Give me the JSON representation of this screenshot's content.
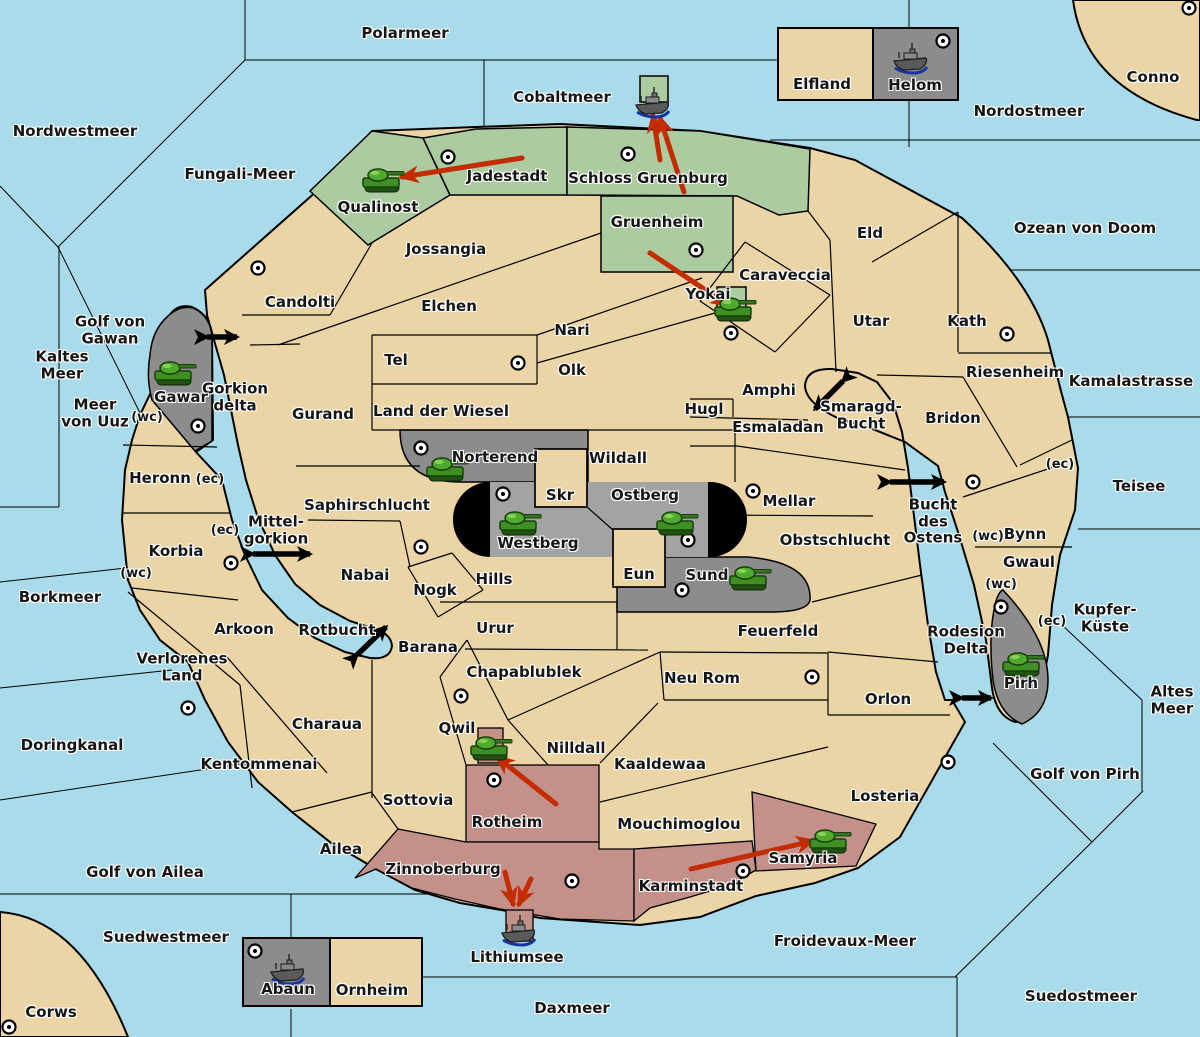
{
  "map": {
    "title": "Gorkion world game map",
    "colors": {
      "water": "#a9dbea",
      "land": "#ebd5a6",
      "green": "#adcba0",
      "gray": "#8c8c8c",
      "gray_light": "#a3a3a3",
      "pink": "#c4908a",
      "black": "#000000",
      "red_arrow": "#c32b00",
      "label": "#161616"
    },
    "sea_labels": [
      {
        "t": "Polarmeer",
        "x": 405,
        "y": 33
      },
      {
        "t": "Nordwestmeer",
        "x": 75,
        "y": 131
      },
      {
        "t": "Fungali-Meer",
        "x": 240,
        "y": 174
      },
      {
        "t": "Cobaltmeer",
        "x": 562,
        "y": 97
      },
      {
        "t": "Nordostmeer",
        "x": 1029,
        "y": 111
      },
      {
        "t": "Ozean von Doom",
        "x": 1085,
        "y": 228
      },
      {
        "t": "Kaltes\nMeer",
        "x": 62,
        "y": 365
      },
      {
        "t": "Golf von\nGawan",
        "x": 110,
        "y": 330
      },
      {
        "t": "Meer\nvon Uuz",
        "x": 95,
        "y": 413
      },
      {
        "t": "Gorkion\ndelta",
        "x": 235,
        "y": 397
      },
      {
        "t": "Kamalastrasse",
        "x": 1131,
        "y": 381
      },
      {
        "t": "Teisee",
        "x": 1139,
        "y": 486
      },
      {
        "t": "Borkmeer",
        "x": 60,
        "y": 597
      },
      {
        "t": "Mittel-\ngorkion",
        "x": 276,
        "y": 530
      },
      {
        "t": "Bucht\ndes\nOstens",
        "x": 933,
        "y": 521
      },
      {
        "t": "Smaragd-\nBucht",
        "x": 861,
        "y": 415
      },
      {
        "t": "Kupfer-\nKüste",
        "x": 1105,
        "y": 618
      },
      {
        "t": "Altes\nMeer",
        "x": 1172,
        "y": 700
      },
      {
        "t": "Rotbucht",
        "x": 337,
        "y": 630
      },
      {
        "t": "Rodesion\nDelta",
        "x": 966,
        "y": 640
      },
      {
        "t": "Doringkanal",
        "x": 72,
        "y": 745
      },
      {
        "t": "Golf von Ailea",
        "x": 145,
        "y": 872
      },
      {
        "t": "Suedwestmeer",
        "x": 166,
        "y": 937
      },
      {
        "t": "Daxmeer",
        "x": 572,
        "y": 1008
      },
      {
        "t": "Froidevaux-Meer",
        "x": 845,
        "y": 941
      },
      {
        "t": "Suedostmeer",
        "x": 1081,
        "y": 996
      },
      {
        "t": "Golf von Pirh",
        "x": 1085,
        "y": 774
      },
      {
        "t": "Lithiumsee",
        "x": 517,
        "y": 957
      }
    ],
    "land_labels": [
      {
        "t": "Elfland",
        "x": 822,
        "y": 84
      },
      {
        "t": "Helom",
        "x": 915,
        "y": 85
      },
      {
        "t": "Conno",
        "x": 1153,
        "y": 77
      },
      {
        "t": "Corws",
        "x": 51,
        "y": 1012
      },
      {
        "t": "Jadestadt",
        "x": 507,
        "y": 176
      },
      {
        "t": "Schloss Gruenburg",
        "x": 648,
        "y": 178
      },
      {
        "t": "Qualinost",
        "x": 378,
        "y": 207
      },
      {
        "t": "Gruenheim",
        "x": 657,
        "y": 222
      },
      {
        "t": "Jossangia",
        "x": 446,
        "y": 249
      },
      {
        "t": "Candolti",
        "x": 300,
        "y": 302
      },
      {
        "t": "Elchen",
        "x": 449,
        "y": 306
      },
      {
        "t": "Yokai",
        "x": 708,
        "y": 294
      },
      {
        "t": "Nari",
        "x": 572,
        "y": 330
      },
      {
        "t": "Eld",
        "x": 870,
        "y": 233
      },
      {
        "t": "Caraveccia",
        "x": 785,
        "y": 275
      },
      {
        "t": "Utar",
        "x": 871,
        "y": 321
      },
      {
        "t": "Kath",
        "x": 967,
        "y": 321
      },
      {
        "t": "Tel",
        "x": 396,
        "y": 360
      },
      {
        "t": "Olk",
        "x": 572,
        "y": 370
      },
      {
        "t": "Riesenheim",
        "x": 1015,
        "y": 372
      },
      {
        "t": "Gawar",
        "x": 181,
        "y": 397
      },
      {
        "t": "Amphi",
        "x": 769,
        "y": 390
      },
      {
        "t": "Hugl",
        "x": 704,
        "y": 409
      },
      {
        "t": "Esmaladan",
        "x": 778,
        "y": 427
      },
      {
        "t": "Bridon",
        "x": 953,
        "y": 418
      },
      {
        "t": "Gurand",
        "x": 323,
        "y": 414
      },
      {
        "t": "Land der Wiesel",
        "x": 441,
        "y": 411
      },
      {
        "t": "Norterend",
        "x": 495,
        "y": 457
      },
      {
        "t": "Wildall",
        "x": 618,
        "y": 458
      },
      {
        "t": "Skr",
        "x": 560,
        "y": 495
      },
      {
        "t": "Ostberg",
        "x": 645,
        "y": 495
      },
      {
        "t": "Westberg",
        "x": 538,
        "y": 543
      },
      {
        "t": "Mellar",
        "x": 789,
        "y": 501
      },
      {
        "t": "Heronn",
        "x": 160,
        "y": 478
      },
      {
        "t": "Saphirschlucht",
        "x": 367,
        "y": 505
      },
      {
        "t": "Korbia",
        "x": 176,
        "y": 551
      },
      {
        "t": "Obstschlucht",
        "x": 835,
        "y": 540
      },
      {
        "t": "Bynn",
        "x": 1025,
        "y": 534
      },
      {
        "t": "Gwaul",
        "x": 1029,
        "y": 562
      },
      {
        "t": "Nabai",
        "x": 365,
        "y": 575
      },
      {
        "t": "Nogk",
        "x": 435,
        "y": 590
      },
      {
        "t": "Hills",
        "x": 494,
        "y": 579
      },
      {
        "t": "Eun",
        "x": 639,
        "y": 574
      },
      {
        "t": "Sund",
        "x": 707,
        "y": 575
      },
      {
        "t": "Urur",
        "x": 495,
        "y": 628
      },
      {
        "t": "Barana",
        "x": 428,
        "y": 647
      },
      {
        "t": "Arkoon",
        "x": 244,
        "y": 629
      },
      {
        "t": "Verlorenes\nLand",
        "x": 182,
        "y": 667
      },
      {
        "t": "Charaua",
        "x": 327,
        "y": 724
      },
      {
        "t": "Kentommenai",
        "x": 259,
        "y": 764
      },
      {
        "t": "Sottovia",
        "x": 418,
        "y": 800
      },
      {
        "t": "Ailea",
        "x": 341,
        "y": 849
      },
      {
        "t": "Chapablublek",
        "x": 524,
        "y": 672
      },
      {
        "t": "Qwil",
        "x": 457,
        "y": 728
      },
      {
        "t": "Nilldall",
        "x": 576,
        "y": 748
      },
      {
        "t": "Kaaldewaa",
        "x": 660,
        "y": 764
      },
      {
        "t": "Neu Rom",
        "x": 702,
        "y": 678
      },
      {
        "t": "Feuerfeld",
        "x": 778,
        "y": 631
      },
      {
        "t": "Orlon",
        "x": 888,
        "y": 699
      },
      {
        "t": "Losteria",
        "x": 885,
        "y": 796
      },
      {
        "t": "Mouchimoglou",
        "x": 679,
        "y": 824
      },
      {
        "t": "Rotheim",
        "x": 507,
        "y": 822
      },
      {
        "t": "Zinnoberburg",
        "x": 443,
        "y": 869
      },
      {
        "t": "Karminstadt",
        "x": 691,
        "y": 886
      },
      {
        "t": "Samyria",
        "x": 803,
        "y": 858
      },
      {
        "t": "Pirh",
        "x": 1021,
        "y": 683
      },
      {
        "t": "Abaun",
        "x": 288,
        "y": 989
      },
      {
        "t": "Ornheim",
        "x": 372,
        "y": 990
      }
    ],
    "marker_labels": [
      {
        "t": "(wc)",
        "x": 147,
        "y": 418
      },
      {
        "t": "(wc)",
        "x": 136,
        "y": 574
      },
      {
        "t": "(wc)",
        "x": 988,
        "y": 537
      },
      {
        "t": "(wc)",
        "x": 1001,
        "y": 585
      },
      {
        "t": "(ec)",
        "x": 210,
        "y": 480
      },
      {
        "t": "(ec)",
        "x": 225,
        "y": 531
      },
      {
        "t": "(ec)",
        "x": 1060,
        "y": 465
      },
      {
        "t": "(ec)",
        "x": 1052,
        "y": 622
      }
    ],
    "cities": [
      [
        448,
        157
      ],
      [
        628,
        154
      ],
      [
        258,
        268
      ],
      [
        1189,
        8
      ],
      [
        943,
        41
      ],
      [
        198,
        426
      ],
      [
        231,
        563
      ],
      [
        518,
        363
      ],
      [
        696,
        250
      ],
      [
        731,
        333
      ],
      [
        1007,
        334
      ],
      [
        421,
        448
      ],
      [
        503,
        494
      ],
      [
        753,
        491
      ],
      [
        688,
        540
      ],
      [
        682,
        590
      ],
      [
        421,
        547
      ],
      [
        973,
        482
      ],
      [
        1001,
        607
      ],
      [
        188,
        708
      ],
      [
        461,
        696
      ],
      [
        812,
        677
      ],
      [
        494,
        780
      ],
      [
        572,
        881
      ],
      [
        743,
        871
      ],
      [
        948,
        762
      ],
      [
        255,
        951
      ],
      [
        9,
        1027
      ]
    ],
    "tanks": [
      [
        381,
        181
      ],
      [
        173,
        374
      ],
      [
        733,
        310
      ],
      [
        445,
        470
      ],
      [
        518,
        524
      ],
      [
        675,
        524
      ],
      [
        748,
        579
      ],
      [
        1021,
        665
      ],
      [
        489,
        749
      ],
      [
        828,
        842
      ]
    ],
    "ships": [
      [
        653,
        103
      ],
      [
        911,
        59
      ],
      [
        288,
        970
      ],
      [
        519,
        931
      ]
    ],
    "red_arrows": [
      {
        "x1": 522,
        "y1": 158,
        "x2": 402,
        "y2": 177
      },
      {
        "x1": 660,
        "y1": 160,
        "x2": 653,
        "y2": 116
      },
      {
        "x1": 684,
        "y1": 192,
        "x2": 660,
        "y2": 118
      },
      {
        "x1": 650,
        "y1": 253,
        "x2": 728,
        "y2": 305
      },
      {
        "x1": 556,
        "y1": 804,
        "x2": 497,
        "y2": 757
      },
      {
        "x1": 691,
        "y1": 869,
        "x2": 813,
        "y2": 841
      },
      {
        "x1": 505,
        "y1": 872,
        "x2": 513,
        "y2": 904
      },
      {
        "x1": 531,
        "y1": 879,
        "x2": 519,
        "y2": 904
      }
    ],
    "black_arrows": [
      {
        "x1": 207,
        "y1": 337,
        "x2": 237,
        "y2": 337
      },
      {
        "x1": 253,
        "y1": 554,
        "x2": 310,
        "y2": 554
      },
      {
        "x1": 843,
        "y1": 381,
        "x2": 815,
        "y2": 409
      },
      {
        "x1": 890,
        "y1": 482,
        "x2": 944,
        "y2": 482
      },
      {
        "x1": 357,
        "y1": 655,
        "x2": 386,
        "y2": 627
      },
      {
        "x1": 962,
        "y1": 698,
        "x2": 991,
        "y2": 698
      }
    ]
  }
}
